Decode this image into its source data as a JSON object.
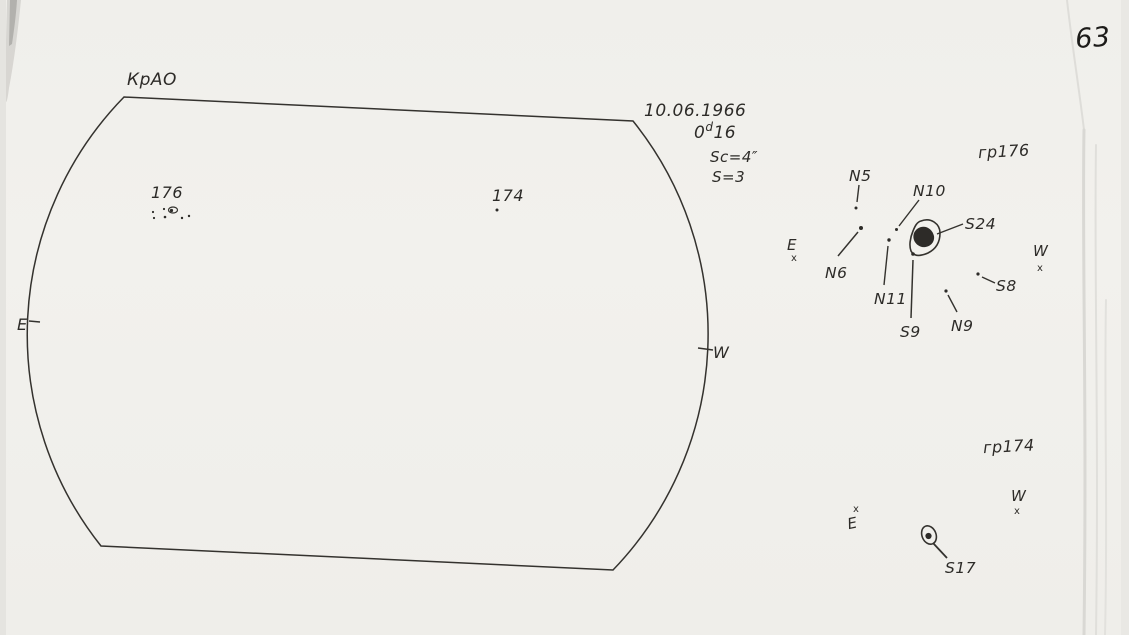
{
  "page": {
    "number": "63",
    "observatory": "КрАО"
  },
  "observation": {
    "date": "10.06.1966",
    "time": {
      "base": "0",
      "sup": "d",
      "rest": "16"
    },
    "scale": "Sc=4″",
    "seeing": "S=3"
  },
  "disk": {
    "east": "E",
    "west": "W",
    "groups": [
      {
        "label": "176"
      },
      {
        "label": "174"
      }
    ]
  },
  "detail_176": {
    "title": "гр176",
    "east": "E",
    "west": "W",
    "cross": "x",
    "spots": {
      "n5": "N5",
      "n6": "N6",
      "n10": "N10",
      "n11": "N11",
      "s24": "S24",
      "s9": "S9",
      "n9": "N9",
      "s8": "S8"
    }
  },
  "detail_174": {
    "title": "гр174",
    "east": "E",
    "west": "W",
    "cross": "x",
    "spots": {
      "s17": "S17"
    }
  },
  "colors": {
    "ink": "#2d2b28",
    "paper": "#f1f0ec"
  }
}
